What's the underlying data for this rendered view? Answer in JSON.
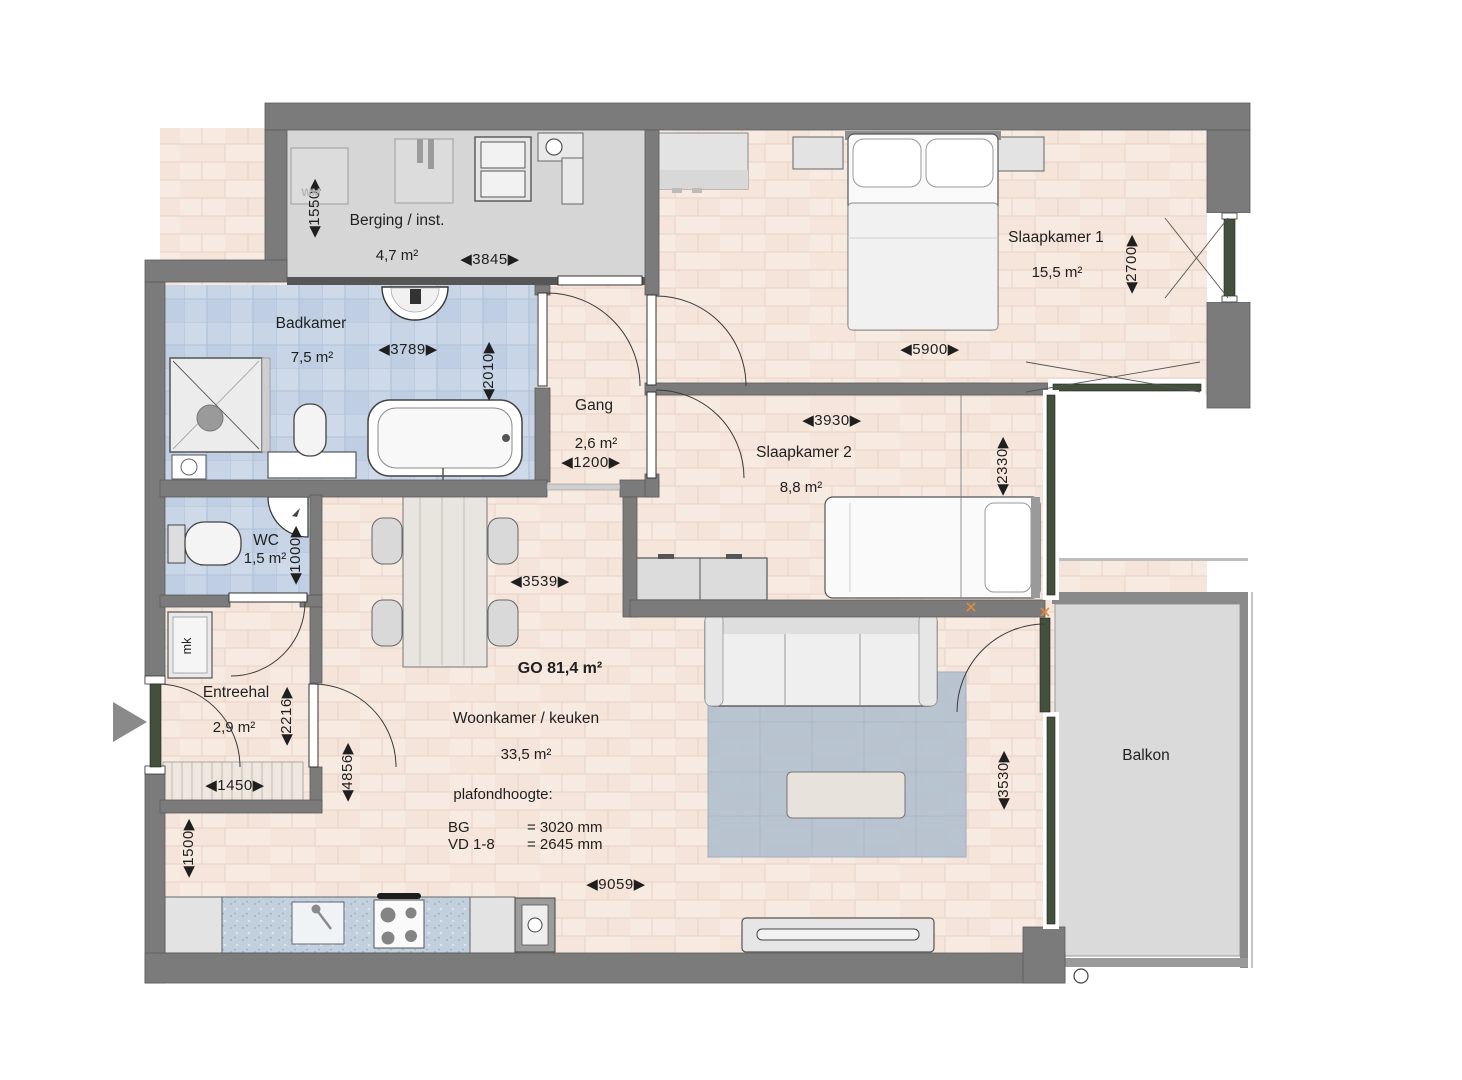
{
  "plan": {
    "rooms": {
      "berging": {
        "name": "Berging / inst.",
        "area": "4,7 m²"
      },
      "badkamer": {
        "name": "Badkamer",
        "area": "7,5 m²"
      },
      "slaapkamer1": {
        "name": "Slaapkamer 1",
        "area": "15,5 m²"
      },
      "gang": {
        "name": "Gang",
        "area": "2,6 m²"
      },
      "slaapkamer2": {
        "name": "Slaapkamer 2",
        "area": "8,8 m²"
      },
      "wc": {
        "name": "WC",
        "area": "1,5 m²"
      },
      "entreehal": {
        "name": "Entreehal",
        "area": "2,9 m²"
      },
      "woonkamer": {
        "name": "Woonkamer / keuken",
        "area": "33,5 m²"
      },
      "balkon": {
        "name": "Balkon"
      }
    },
    "summary": {
      "go": "GO 81,4 m²",
      "ceiling_title": "plafondhoogte:",
      "bg_label": "BG",
      "bg_value": "= 3020 mm",
      "vd_label": "VD 1-8",
      "vd_value": "= 2645 mm"
    },
    "dims": {
      "berging_w": "◀3845▶",
      "berging_h": "◀1550▶",
      "badkamer_w": "◀3789▶",
      "badkamer_h": "◀2010▶",
      "sk1_w": "◀5900▶",
      "sk1_h": "◀2700▶",
      "gang_w": "◀1200▶",
      "sk2_w": "◀3930▶",
      "sk2_h": "◀2330▶",
      "wc_h": "◀1000▶",
      "hal_w": "◀1450▶",
      "hal_h": "◀2216▶",
      "dining_w": "◀3539▶",
      "living_h": "◀4856▶",
      "kitchen_h": "◀1500▶",
      "living_w": "◀9059▶",
      "balkon_h": "◀3530▶"
    },
    "fixtures": {
      "wm": "WM",
      "mk": "mk"
    },
    "colors": {
      "wall": "#7b7b7b",
      "window_frame": "#42503c",
      "tile_floor": "#c7d5e7",
      "wood_floor": "#f7eae1",
      "balcony_floor": "#dadada",
      "rug": "#b3c0d0",
      "hinge_mark": "#e08a3c"
    }
  }
}
